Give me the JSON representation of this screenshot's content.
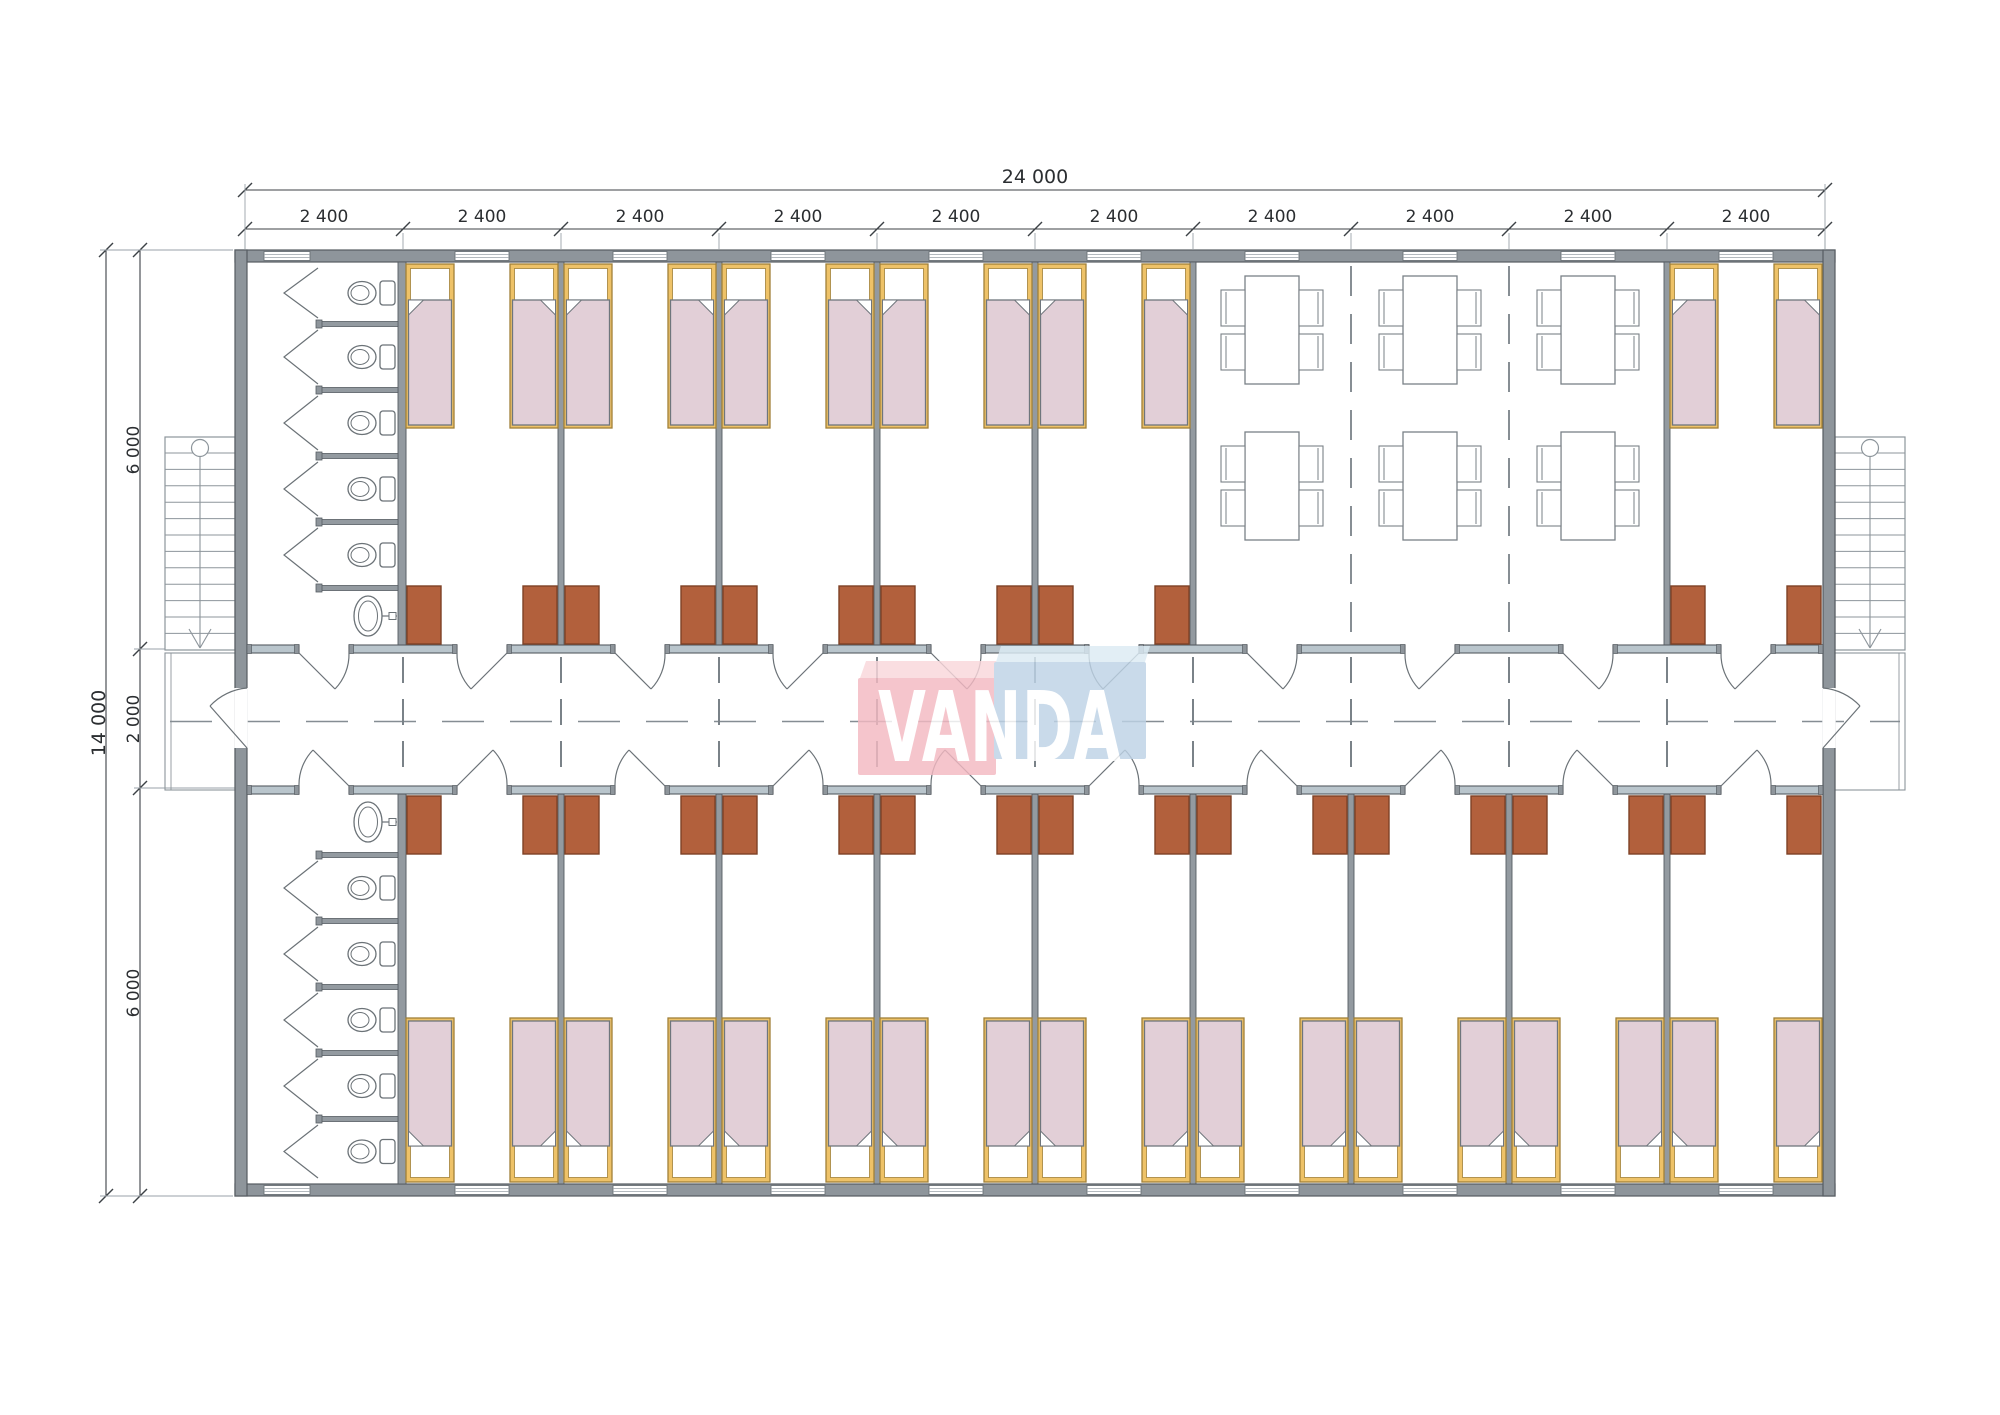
{
  "logo": {
    "text": "VANDA",
    "pink": "#f3b9c2",
    "pink_top": "#f9d7db",
    "blue": "#bed3e6",
    "blue_top": "#dcebf4",
    "text_color": "#ffffff"
  },
  "dimensions": {
    "overall_width": "24 000",
    "module_width": "2 400",
    "module_count": 10,
    "overall_depth": "14 000",
    "top_wing_depth": "6 000",
    "corridor_width": "2 000",
    "bottom_wing_depth": "6 000"
  },
  "inventory": {
    "single_beds": 30,
    "wardrobes": 30,
    "wc_stalls": 10,
    "wash_basins": 2,
    "dining_tables": 6,
    "chairs_per_table": 4,
    "staircases": 2,
    "stair_treads": 13,
    "entry_doors": 2,
    "room_doors": 20,
    "windows": 20
  },
  "colors": {
    "paper": "#ffffff",
    "wall_fill": "#8e959b",
    "wall_stroke": "#565c62",
    "light_wall_fill": "#b9c5cc",
    "partition_fill": "#939aa0",
    "bed_frame": "#eec268",
    "bed_frame_stroke": "#a08038",
    "bedding": "#e2cfd7",
    "bedding_stroke": "#6f767c",
    "pillow": "#ffffff",
    "wardrobe": "#b2603c",
    "wardrobe_stroke": "#7e4226",
    "fixture_stroke": "#6b7277",
    "furniture_stroke": "#7a8187",
    "dash": "#7a8288",
    "centerline": "#858d93",
    "dim_line": "#3c4146",
    "ext_line": "#9aa2a8",
    "stairs_line": "#8d959b",
    "dim_text": "#2b2e31"
  }
}
